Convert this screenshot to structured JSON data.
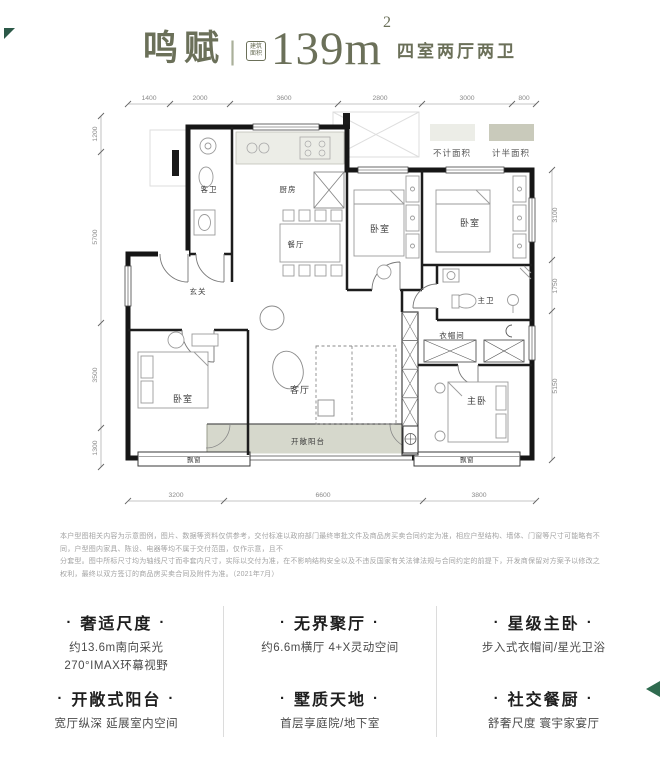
{
  "header": {
    "name": "鸣赋",
    "divider": "|",
    "badge": {
      "line1": "建筑",
      "line2": "面积"
    },
    "area_value": "139m",
    "area_sup": "2",
    "subtitle": "四室两厅两卫"
  },
  "legend": {
    "items": [
      {
        "label": "不计面积",
        "color": "#ecede7"
      },
      {
        "label": "计半面积",
        "color": "#c9cabb"
      }
    ]
  },
  "plan": {
    "dims": {
      "top": [
        "1400",
        "2000",
        "3600",
        "2800",
        "3000",
        "800"
      ],
      "bottom": [
        "3200",
        "6600",
        "3800"
      ],
      "left": [
        "1200",
        "5700",
        "3500",
        "1300"
      ],
      "right": [
        "3100",
        "1750",
        "5150"
      ]
    },
    "rooms": {
      "guest_bath": "客卫",
      "foyer": "玄关",
      "kitchen": "厨房",
      "dining": "餐厅",
      "living": "客厅",
      "balcony": "开敞阳台",
      "bedroom": "卧室",
      "master_bath": "主卫",
      "cloakroom": "衣帽间",
      "master_bedroom": "主卧",
      "bay_window": "飘窗"
    }
  },
  "disclaimer": {
    "lines": [
      "本户型图相关内容为示意图例，图片、数据等资料仅供参考，交付标准以政府部门最终审批文件及商品房买卖合同约定为准，相应户型结构、墙体、门窗等尺寸可能略有不同，户型图内家具、陈设、电器等均不属于交付范围，仅作示意，且不",
      "分套型。图中所标尺寸均为轴线尺寸而非套内尺寸，实际以交付为准，在不影响结构安全以及不违反国家有关法律法规与合同约定的前提下，开发商保留对方案予以修改之权利，最终以双方签订的商品房买卖合同及附件为准。（2021年7月）"
    ]
  },
  "features": {
    "bullet": "·",
    "columns": [
      {
        "blocks": [
          {
            "title": "奢适尺度",
            "lines": [
              "约13.6m南向采光",
              "270°IMAX环幕视野"
            ]
          },
          {
            "title": "开敞式阳台",
            "lines": [
              "宽厅纵深 延展室内空间"
            ]
          }
        ]
      },
      {
        "blocks": [
          {
            "title": "无界聚厅",
            "lines": [
              "约6.6m横厅 4+X灵动空间"
            ]
          },
          {
            "title": "墅质天地",
            "lines": [
              "首层享庭院/地下室"
            ]
          }
        ]
      },
      {
        "blocks": [
          {
            "title": "星级主卧",
            "lines": [
              "步入式衣帽间/星光卫浴"
            ]
          },
          {
            "title": "社交餐厨",
            "lines": [
              "舒奢尺度 寰宇家宴厅"
            ]
          }
        ]
      }
    ]
  }
}
